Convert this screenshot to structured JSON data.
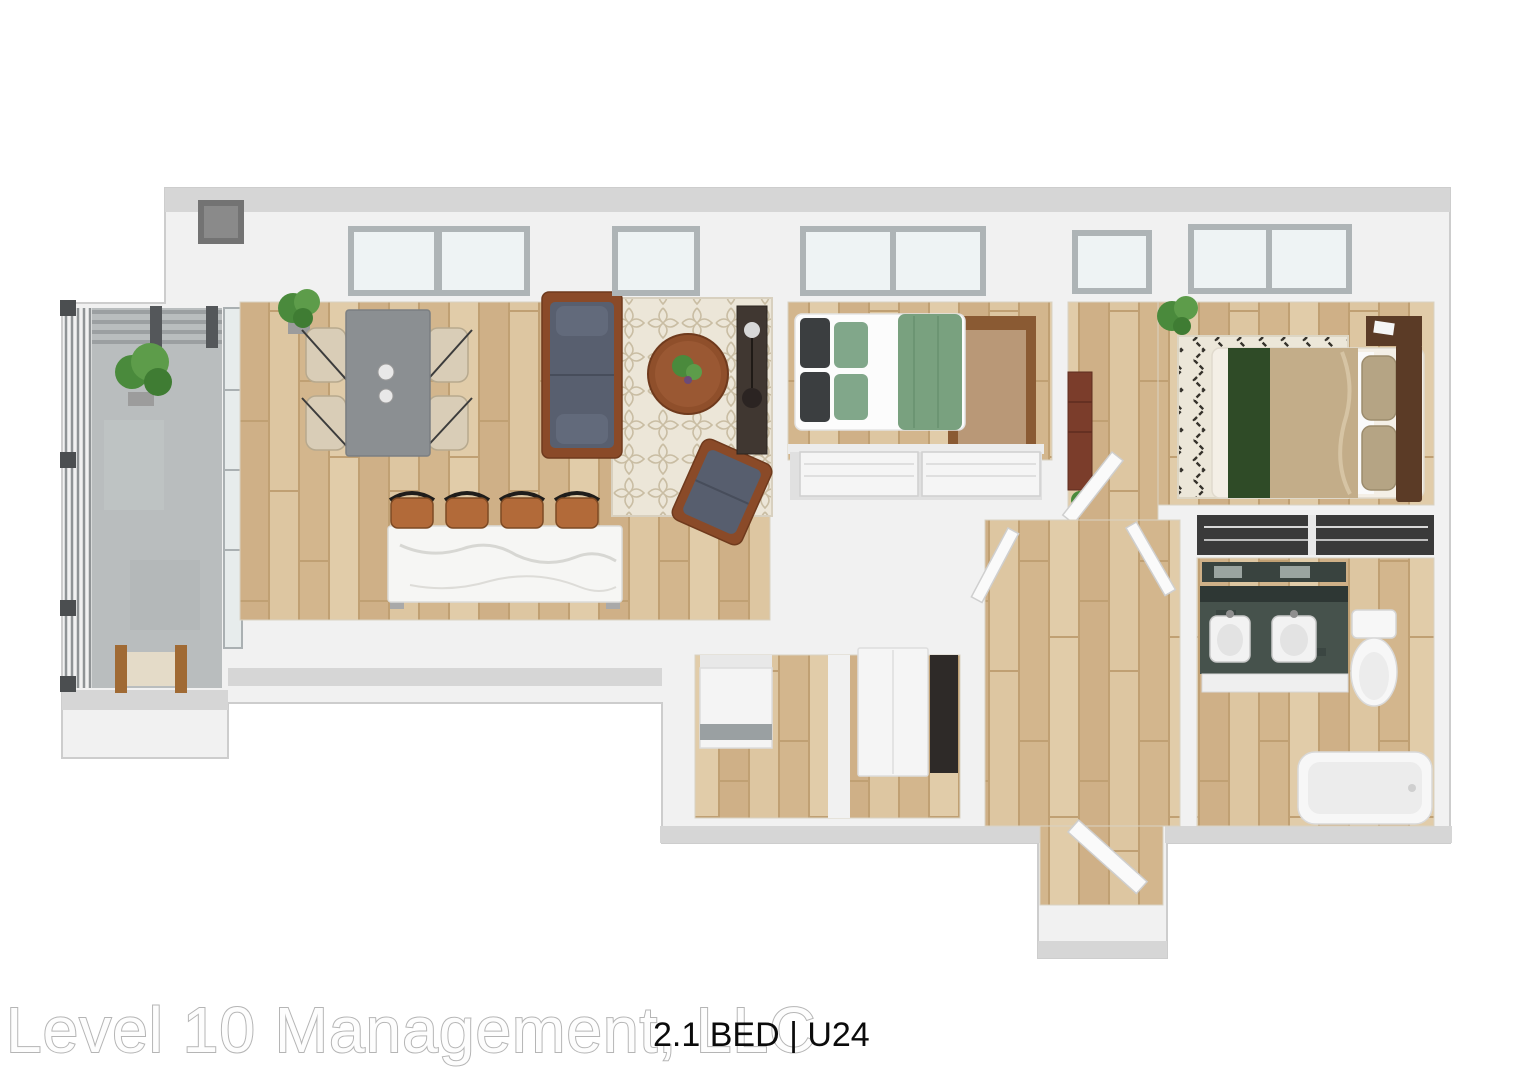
{
  "watermark": {
    "text": "Level 10 Management, LLC"
  },
  "unit_badge": {
    "text": "2.1 BED | U24"
  },
  "palette": {
    "background": "#ffffff",
    "wall_face": "#f1f1f1",
    "wall_top": "#d6d6d6",
    "wood_floor": "#d8bf9a",
    "balcony_concrete": "#b9bdbe",
    "rug_cream": "#ece6d8",
    "sofa_blue_gray": "#585f6f",
    "wood_furniture": "#8a4a28",
    "stool_leather": "#b26a39",
    "dining_table_gray": "#8b8f92",
    "chair_beige": "#d9cdb7",
    "bed1_green": "#79a17f",
    "bed2_tan": "#c3ad89",
    "bed2_runner_green": "#2f4b27",
    "vanity_counter": "#46524c",
    "plant_green": "#4a8a3c",
    "watermark_stroke": "#b5b5b5",
    "label_black": "#0b0b0b"
  },
  "scene": {
    "type": "3d-floor-plan",
    "rooms": [
      {
        "name": "balcony",
        "features": [
          "metal-railing",
          "pergola-slats",
          "potted-plant",
          "outdoor-chair",
          "concrete-floor"
        ]
      },
      {
        "name": "living-dining-kitchen",
        "features": [
          "gray-dining-table",
          "four-beige-chairs",
          "blue-gray-sofa",
          "round-coffee-table",
          "trellis-rug",
          "armchair",
          "media-console",
          "marble-kitchen-island",
          "four-leather-bar-stools",
          "corner-plant",
          "windows",
          "glass-wall-to-balcony"
        ]
      },
      {
        "name": "bedroom-1",
        "features": [
          "double-bed-green-bedding",
          "brown-area-rug",
          "sliding-door-closet",
          "windows"
        ]
      },
      {
        "name": "vestibule",
        "features": [
          "dresser",
          "open-door",
          "window"
        ]
      },
      {
        "name": "bedroom-2",
        "features": [
          "double-bed-tan-bedding-green-runner",
          "zigzag-rug",
          "headboard",
          "nightstand",
          "potted-plant",
          "windows"
        ]
      },
      {
        "name": "bathroom",
        "features": [
          "double-vanity-dark-counter",
          "mirror",
          "toilet",
          "bathtub",
          "linen-closet"
        ]
      },
      {
        "name": "laundry-closet",
        "features": [
          "washer-dryer",
          "white-cabinet",
          "open-closet"
        ]
      },
      {
        "name": "hallway",
        "features": [
          "open-doors"
        ]
      },
      {
        "name": "entry",
        "features": [
          "open-entry-door"
        ]
      }
    ]
  }
}
